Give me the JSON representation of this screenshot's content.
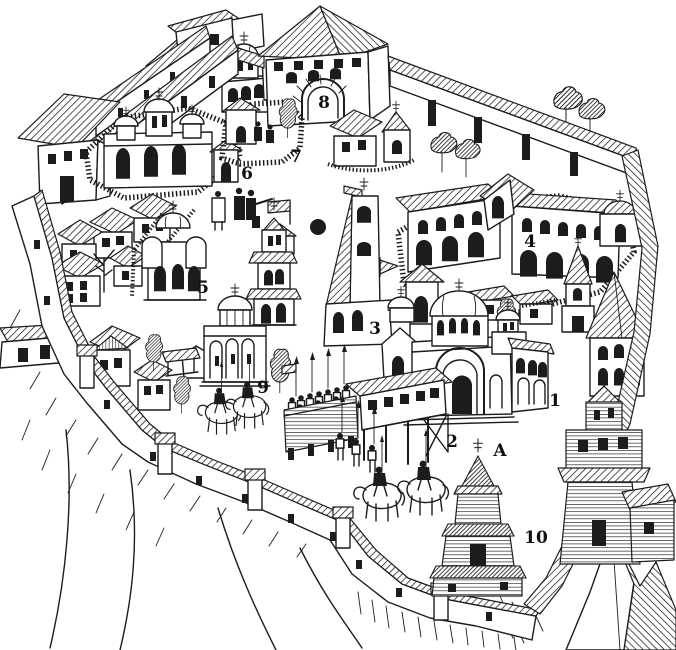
{
  "figure": {
    "background": "#ffffff",
    "ink": "#1c1c1c",
    "style": "black-and-white woodcut engraving",
    "subject": "bird's-eye pictorial plan of a fortified medieval town with numbered landmarks"
  },
  "labels": [
    {
      "text": "1"
    },
    {
      "text": "2"
    },
    {
      "text": "3"
    },
    {
      "text": "4"
    },
    {
      "text": "5"
    },
    {
      "text": "6"
    },
    {
      "text": "7"
    },
    {
      "text": "8"
    },
    {
      "text": "9"
    },
    {
      "text": "10"
    },
    {
      "text": "A"
    }
  ],
  "marker": {
    "type": "filled-dot"
  }
}
